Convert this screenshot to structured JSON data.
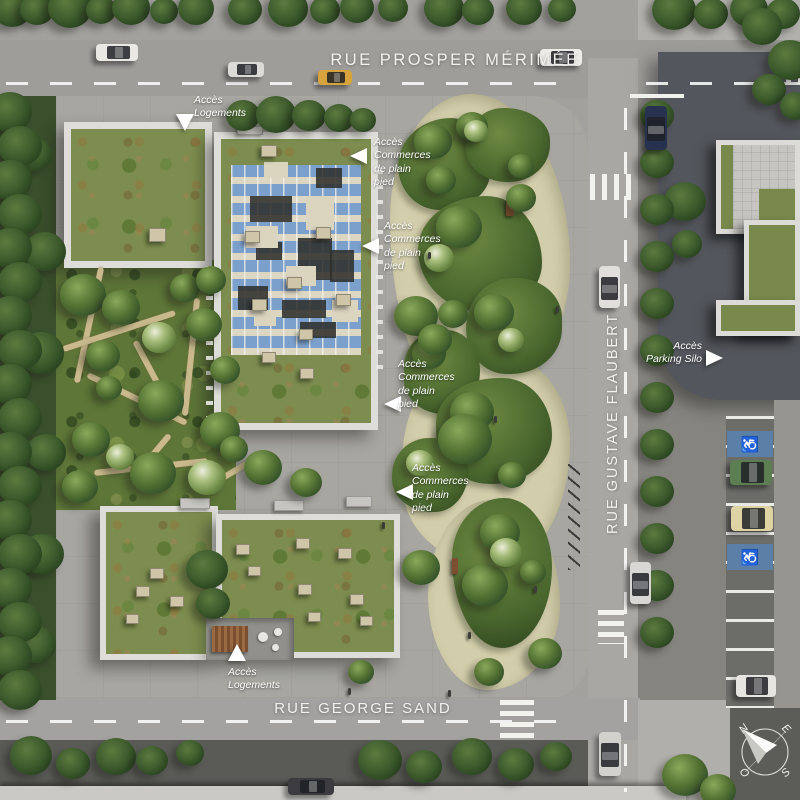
{
  "streets": {
    "top": {
      "name": "RUE PROSPER MÉRIMÉE"
    },
    "right": {
      "name": "RUE GUSTAVE FLAUBERT"
    },
    "bottom": {
      "name": "RUE GEORGE SAND"
    }
  },
  "annotations": {
    "logements_top": {
      "line1": "Accès",
      "line2": "Logements"
    },
    "commerces_1": {
      "line1": "Accès",
      "line2": "Commerces",
      "line3": "de plain",
      "line4": "pied"
    },
    "commerces_2": {
      "line1": "Accès",
      "line2": "Commerces",
      "line3": "de plain",
      "line4": "pied"
    },
    "commerces_3": {
      "line1": "Accès",
      "line2": "Commerces",
      "line3": "de plain",
      "line4": "pied"
    },
    "commerces_4": {
      "line1": "Accès",
      "line2": "Commerces",
      "line3": "de plain",
      "line4": "pied"
    },
    "parking_silo": {
      "line1": "Accès",
      "line2": "Parking Silo"
    },
    "logements_bottom": {
      "line1": "Accès",
      "line2": "Logements"
    }
  },
  "compass": {
    "north": "N",
    "east": "E",
    "south": "S",
    "west": "O"
  },
  "symbols": {
    "accessible_parking": "♿"
  },
  "colors": {
    "road": "#9e9d9a",
    "plaza": "#a7a6a1",
    "park_path": "#d2cdab",
    "green_roof": "#7d8d4f",
    "solar_panel": "#7ca0cc",
    "accessible_bay": "#5b7fa6",
    "dark_sidewalk": "#5a5a57",
    "silo_grounds": "#53565c",
    "label_text": "#f2f1ee"
  }
}
